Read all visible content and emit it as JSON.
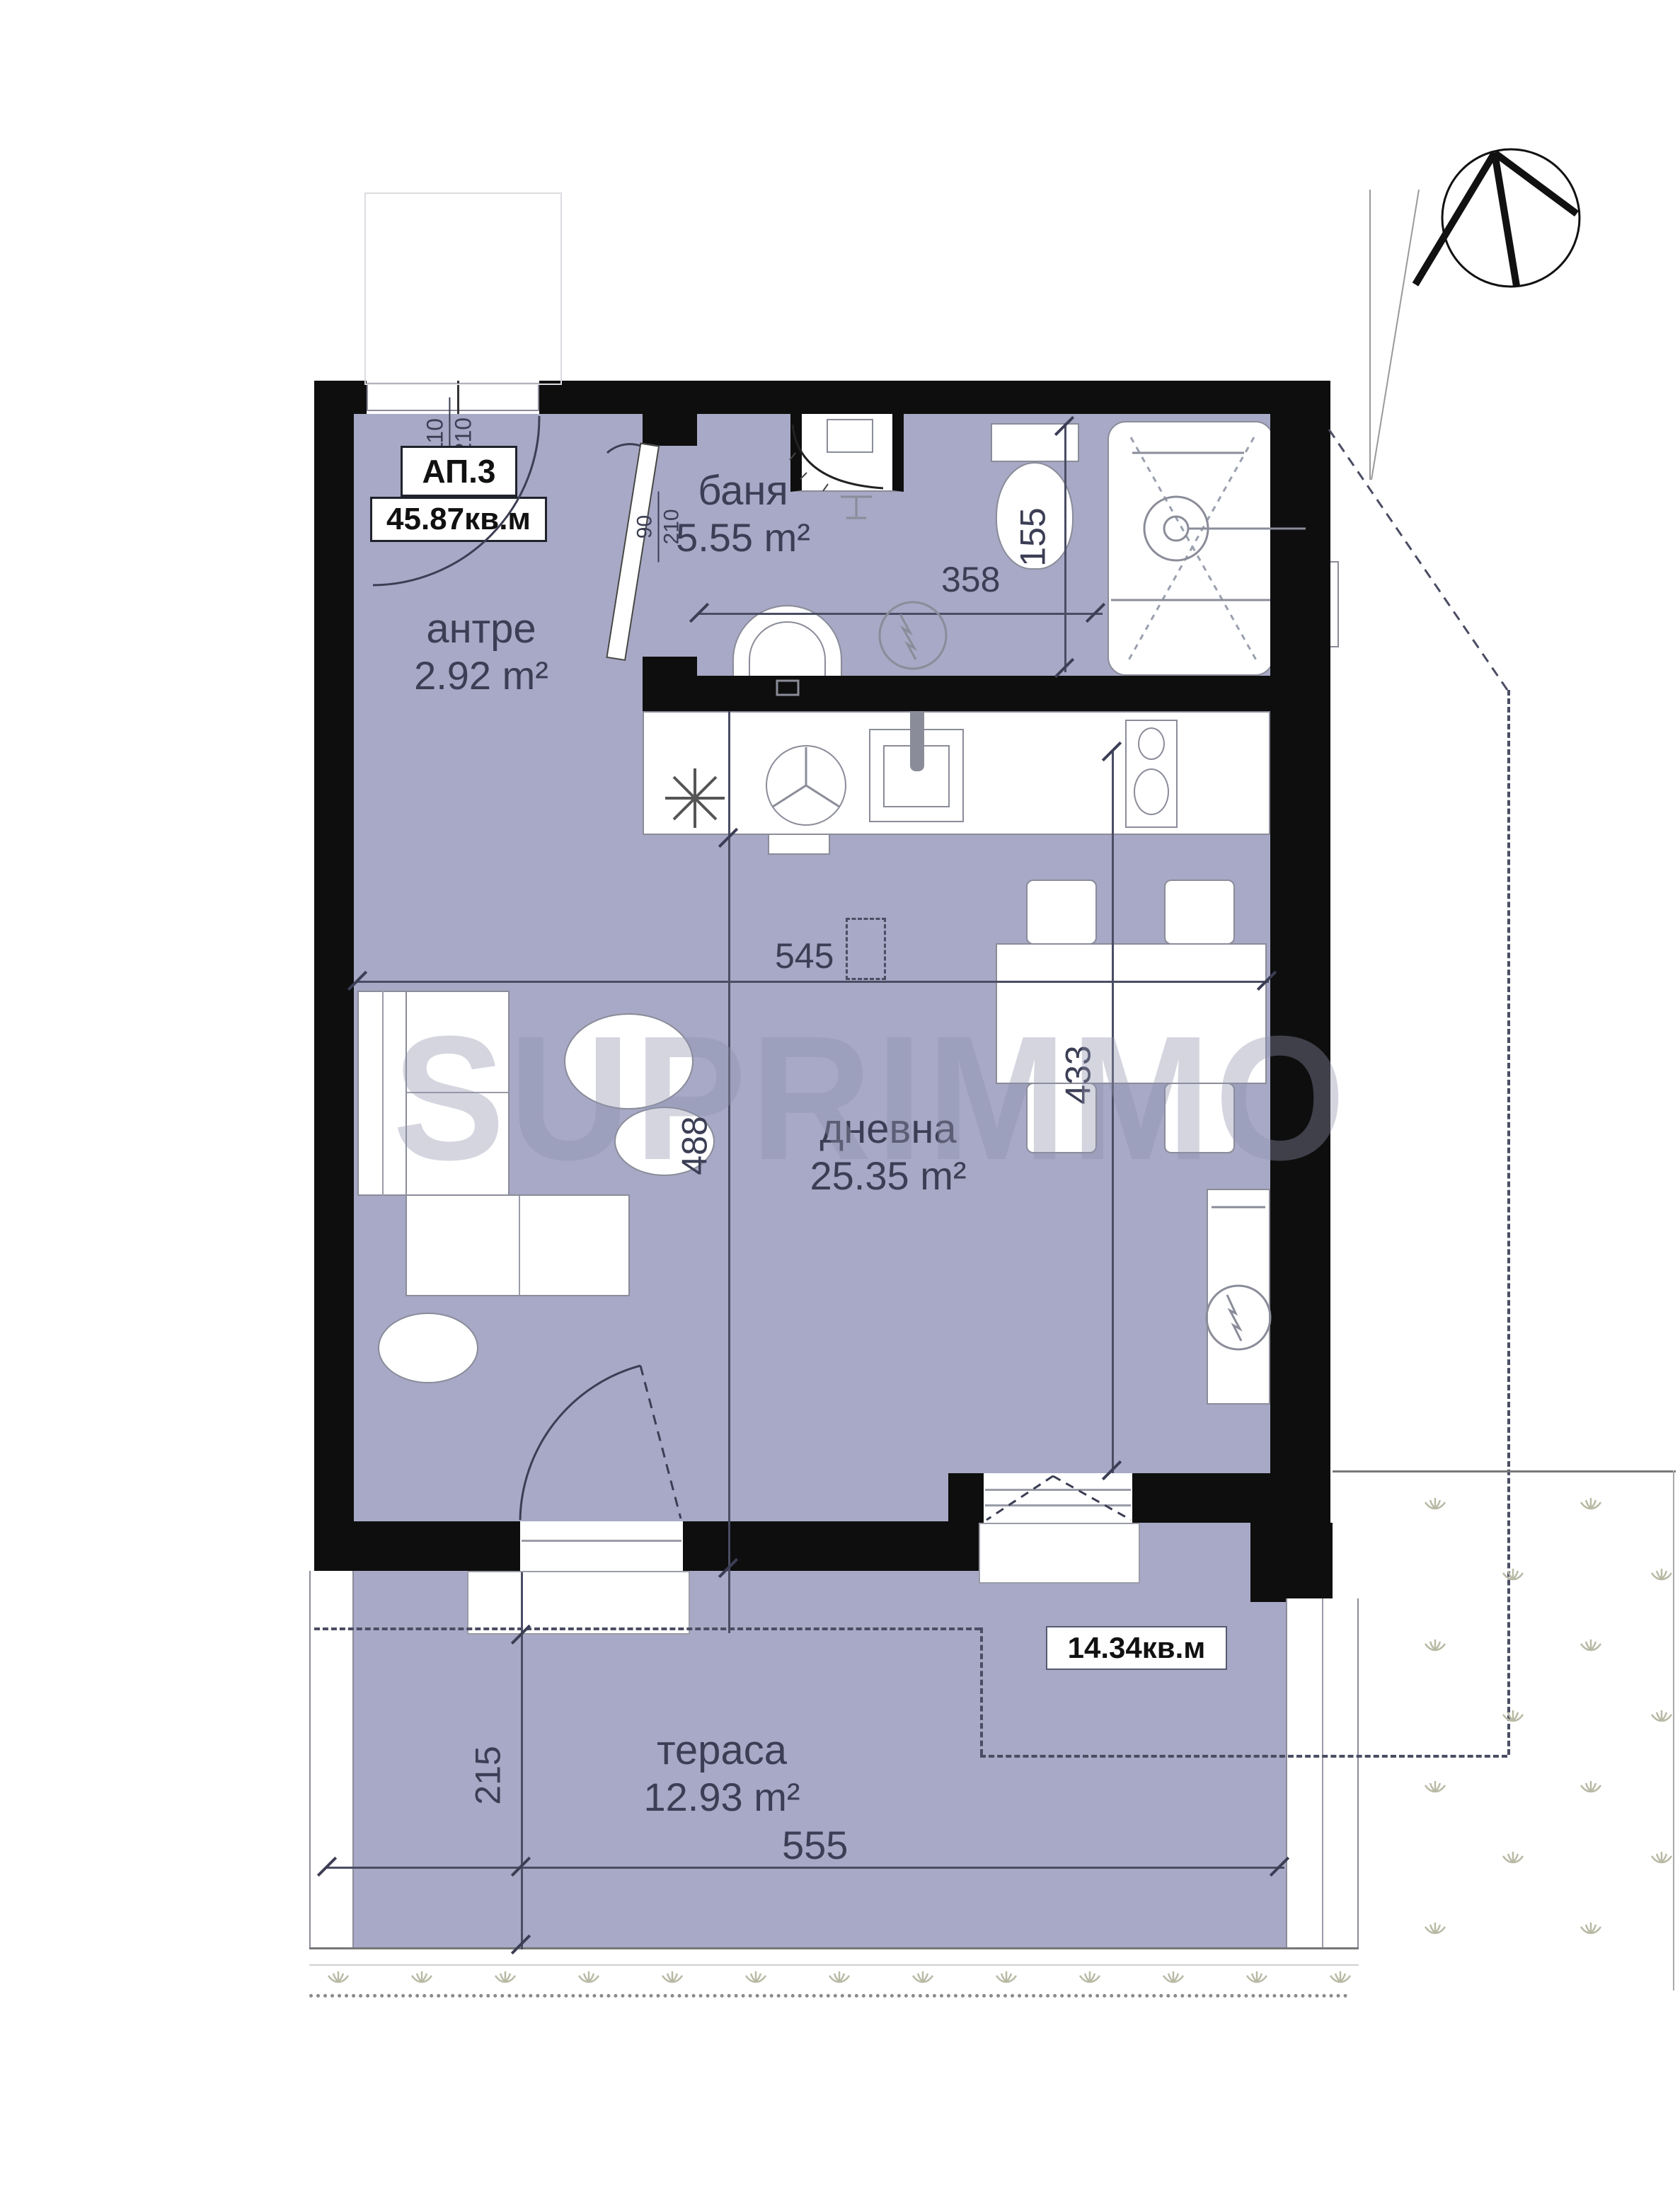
{
  "apartment_label": {
    "id": "АП.3",
    "area": "45.87кв.м"
  },
  "rooms": [
    {
      "name": "антре",
      "area": "2.92 m²"
    },
    {
      "name": "баня",
      "area": "5.55 m²"
    },
    {
      "name": "дневна",
      "area": "25.35 m²"
    },
    {
      "name": "тераса",
      "area": "12.93 m²"
    }
  ],
  "terrace_label": "14.34кв.м",
  "watermark": "SUPRIMMO",
  "dimensions": {
    "entrance_door_width": "110",
    "entrance_door_height": "210",
    "bath_door_width": "90",
    "bath_door_height": "210",
    "bath_width": "358",
    "shower_length": "155",
    "living_width": "545",
    "living_depth": "488",
    "dining_depth": "433",
    "terrace_depth": "215",
    "terrace_width": "555"
  },
  "colors": {
    "room_fill": "#a7a9c6",
    "wall": "#0e0e0e",
    "dimension": "#3b3e54",
    "furniture_outline": "#8a8c99",
    "grass": "#b9baa5"
  },
  "icons": [
    "north-arrow-icon",
    "grass-icon"
  ]
}
